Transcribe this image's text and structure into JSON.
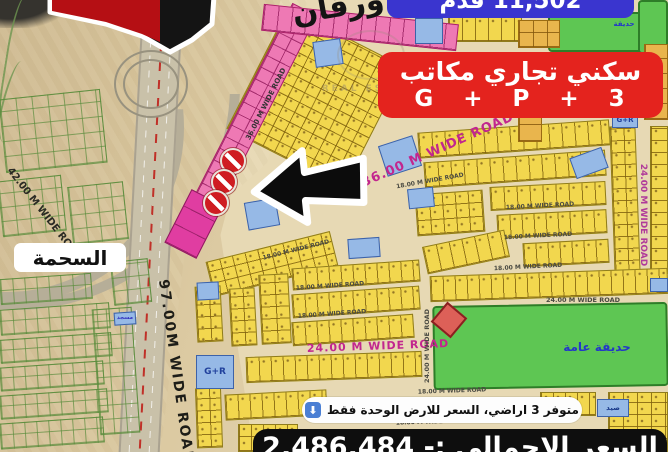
{
  "top_banner": {
    "text": "11,502 قدم",
    "bg": "#3a35cf"
  },
  "zoning_banner": {
    "line1": "سكني تجاري مكاتب",
    "line2": "G + P + 3",
    "bg": "#e4231e"
  },
  "district_label": {
    "text": "السحمة"
  },
  "availability_pill": {
    "text": "متوفر 3 اراضي، السعر للارض الوحدة فقط",
    "arrow_icon": "⬇"
  },
  "price_banner": {
    "text": "السعر الاجمالي :- 2,486,484"
  },
  "watermark": {
    "text": "REAL ESTATE"
  },
  "map": {
    "colors": {
      "plot_yellow": "#f2d74e",
      "plot_pink": "#ee79b4",
      "plot_magenta": "#e03da1",
      "plot_blue": "#96b9e6",
      "park_green": "#5ec653",
      "plot_orange": "#e9b54d",
      "road_text_magenta": "#c2268e",
      "banner_blue": "#3a35cf",
      "banner_red": "#e4231e",
      "marker_red": "#cf1d22"
    },
    "labels": [
      {
        "t": "ورقان",
        "x": 338,
        "y": 7,
        "r": -10,
        "s": 30,
        "c": "#141414",
        "rtl": true
      },
      {
        "t": "36.00 M WIDE ROAD",
        "x": 266,
        "y": 104,
        "r": -63,
        "s": 7,
        "c": "#333333"
      },
      {
        "t": "36.00 M WIDE ROAD",
        "x": 438,
        "y": 150,
        "r": -24,
        "s": 13,
        "c": "#c2268e",
        "ls": 1
      },
      {
        "t": "24.00 M WIDE ROAD",
        "x": 378,
        "y": 346,
        "r": -2,
        "s": 11,
        "c": "#c2268e",
        "ls": 1
      },
      {
        "t": "24.00 M WIDE ROAD",
        "x": 643,
        "y": 215,
        "r": 90,
        "s": 9,
        "c": "#b03a9a"
      },
      {
        "t": "24.00 M WIDE ROAD",
        "x": 583,
        "y": 300,
        "r": 0,
        "s": 6.5,
        "c": "#4a4a42"
      },
      {
        "t": "24.00 M WIDE ROAD",
        "x": 427,
        "y": 346,
        "r": -90,
        "s": 6.5,
        "c": "#4a4a42"
      },
      {
        "t": "18.00 M WIDE ROAD",
        "x": 430,
        "y": 181,
        "r": -10,
        "s": 6,
        "c": "#4a4a42"
      },
      {
        "t": "18.00 M WIDE ROAD",
        "x": 540,
        "y": 206,
        "r": -3,
        "s": 6,
        "c": "#4a4a42"
      },
      {
        "t": "18.00 M WIDE ROAD",
        "x": 538,
        "y": 236,
        "r": -3,
        "s": 6,
        "c": "#4a4a42"
      },
      {
        "t": "18.00 M WIDE ROAD",
        "x": 528,
        "y": 267,
        "r": -3,
        "s": 6,
        "c": "#4a4a42"
      },
      {
        "t": "18.00 M WIDE ROAD",
        "x": 296,
        "y": 250,
        "r": -14,
        "s": 6,
        "c": "#4a4a42"
      },
      {
        "t": "18.00 M WIDE ROAD",
        "x": 330,
        "y": 286,
        "r": -4,
        "s": 6,
        "c": "#4a4a42"
      },
      {
        "t": "18.00 M WIDE ROAD",
        "x": 332,
        "y": 314,
        "r": -4,
        "s": 6,
        "c": "#4a4a42"
      },
      {
        "t": "18.00 M WIDE ROAD",
        "x": 452,
        "y": 391,
        "r": -2,
        "s": 6,
        "c": "#4a4a42"
      },
      {
        "t": "18.00 M WIDE ROAD",
        "x": 430,
        "y": 422,
        "r": -2,
        "s": 6,
        "c": "#4a4a42"
      },
      {
        "t": "42.00 M WIDE ROAD",
        "x": 44,
        "y": 214,
        "r": 52,
        "s": 10,
        "c": "#2a2a24"
      },
      {
        "t": "97.00M WIDE ROAD",
        "x": 176,
        "y": 372,
        "r": 82,
        "s": 14,
        "c": "#1d1d18",
        "ls": 2
      },
      {
        "t": "G+R",
        "x": 215,
        "y": 372,
        "r": 0,
        "s": 9,
        "c": "#20409c"
      },
      {
        "t": "G+R",
        "x": 625,
        "y": 120,
        "r": 0,
        "s": 7,
        "c": "#20409c"
      },
      {
        "t": "حديقة عامة",
        "x": 597,
        "y": 347,
        "r": 0,
        "s": 12,
        "c": "#2438c8",
        "rtl": true
      },
      {
        "t": "حديقة",
        "x": 624,
        "y": 24,
        "r": 0,
        "s": 7,
        "c": "#2438c8",
        "rtl": true
      },
      {
        "t": "مسجد",
        "x": 125,
        "y": 318,
        "r": 0,
        "s": 5.5,
        "c": "#3636c0",
        "rtl": true
      },
      {
        "t": "صيد",
        "x": 613,
        "y": 408,
        "r": 0,
        "s": 7,
        "c": "#1a3a8a",
        "rtl": true
      }
    ],
    "plot_blocks": [
      {
        "k": "outline",
        "x": 2,
        "y": 94,
        "w": 102,
        "h": 74,
        "r": -6,
        "cw": 16,
        "ch": 15
      },
      {
        "k": "outline",
        "x": 0,
        "y": 178,
        "w": 64,
        "h": 56,
        "r": -6,
        "cw": 14,
        "ch": 14
      },
      {
        "k": "outline",
        "x": 70,
        "y": 184,
        "w": 56,
        "h": 58,
        "r": -6,
        "cw": 14,
        "ch": 14
      },
      {
        "k": "outline",
        "x": 112,
        "y": 260,
        "w": 38,
        "h": 44,
        "r": -6,
        "cw": 13,
        "ch": 13
      },
      {
        "k": "outline",
        "x": 0,
        "y": 276,
        "w": 92,
        "h": 26,
        "r": -4,
        "cw": 12,
        "ch": 13
      },
      {
        "k": "outline",
        "x": 0,
        "y": 306,
        "w": 110,
        "h": 26,
        "r": -4,
        "cw": 12,
        "ch": 13
      },
      {
        "k": "outline",
        "x": 0,
        "y": 336,
        "w": 112,
        "h": 24,
        "r": -4,
        "cw": 12,
        "ch": 12
      },
      {
        "k": "outline",
        "x": 0,
        "y": 364,
        "w": 104,
        "h": 24,
        "r": -4,
        "cw": 12,
        "ch": 12
      },
      {
        "k": "outline",
        "x": 0,
        "y": 392,
        "w": 108,
        "h": 24,
        "r": -4,
        "cw": 12,
        "ch": 12
      },
      {
        "k": "outline",
        "x": 0,
        "y": 420,
        "w": 104,
        "h": 26,
        "r": -4,
        "cw": 12,
        "ch": 13
      },
      {
        "k": "outline",
        "x": 96,
        "y": 308,
        "w": 40,
        "h": 126,
        "r": -4,
        "cw": 13,
        "ch": 14
      },
      {
        "k": "green",
        "x": 548,
        "y": 12,
        "w": 122,
        "h": 40,
        "r": 0
      },
      {
        "k": "green",
        "x": 638,
        "y": 0,
        "w": 30,
        "h": 54,
        "r": 0
      },
      {
        "k": "green",
        "x": 433,
        "y": 304,
        "w": 235,
        "h": 84,
        "r": -1
      },
      {
        "k": "yellow",
        "x": 250,
        "y": 30,
        "w": 132,
        "h": 136,
        "r": 27,
        "cw": 13,
        "ch": 11
      },
      {
        "k": "yellow",
        "x": 448,
        "y": 16,
        "w": 74,
        "h": 26,
        "r": 0,
        "cw": 13,
        "ch": 26
      },
      {
        "k": "yellow",
        "x": 418,
        "y": 126,
        "w": 192,
        "h": 26,
        "r": -4,
        "cw": 13,
        "ch": 26
      },
      {
        "k": "yellow",
        "x": 424,
        "y": 156,
        "w": 182,
        "h": 26,
        "r": -4,
        "cw": 13,
        "ch": 26
      },
      {
        "k": "yellow",
        "x": 416,
        "y": 192,
        "w": 68,
        "h": 42,
        "r": -4,
        "cw": 13,
        "ch": 14
      },
      {
        "k": "yellow",
        "x": 490,
        "y": 184,
        "w": 116,
        "h": 24,
        "r": -3,
        "cw": 13,
        "ch": 24
      },
      {
        "k": "yellow",
        "x": 612,
        "y": 126,
        "w": 26,
        "h": 148,
        "r": -2,
        "cw": 13,
        "ch": 12
      },
      {
        "k": "yellow",
        "x": 650,
        "y": 126,
        "w": 18,
        "h": 148,
        "r": 0,
        "cw": 18,
        "ch": 12
      },
      {
        "k": "yellow",
        "x": 497,
        "y": 212,
        "w": 110,
        "h": 24,
        "r": -3,
        "cw": 12,
        "ch": 24
      },
      {
        "k": "yellow",
        "x": 523,
        "y": 241,
        "w": 86,
        "h": 24,
        "r": -3,
        "cw": 12,
        "ch": 24
      },
      {
        "k": "yellow",
        "x": 424,
        "y": 238,
        "w": 84,
        "h": 28,
        "r": -12,
        "cw": 13,
        "ch": 28
      },
      {
        "k": "yellow",
        "x": 430,
        "y": 272,
        "w": 238,
        "h": 26,
        "r": -2,
        "cw": 12,
        "ch": 26
      },
      {
        "k": "yellow",
        "x": 208,
        "y": 246,
        "w": 128,
        "h": 36,
        "r": -14,
        "cw": 13,
        "ch": 12
      },
      {
        "k": "yellow",
        "x": 196,
        "y": 286,
        "w": 26,
        "h": 56,
        "r": -3,
        "cw": 13,
        "ch": 12
      },
      {
        "k": "yellow",
        "x": 230,
        "y": 288,
        "w": 26,
        "h": 58,
        "r": -3,
        "cw": 13,
        "ch": 12
      },
      {
        "k": "yellow",
        "x": 260,
        "y": 274,
        "w": 30,
        "h": 70,
        "r": -3,
        "cw": 15,
        "ch": 12
      },
      {
        "k": "yellow",
        "x": 292,
        "y": 264,
        "w": 128,
        "h": 22,
        "r": -4,
        "cw": 12,
        "ch": 22
      },
      {
        "k": "yellow",
        "x": 292,
        "y": 290,
        "w": 128,
        "h": 24,
        "r": -4,
        "cw": 12,
        "ch": 24
      },
      {
        "k": "yellow",
        "x": 292,
        "y": 318,
        "w": 122,
        "h": 24,
        "r": -4,
        "cw": 12,
        "ch": 24
      },
      {
        "k": "yellow",
        "x": 246,
        "y": 354,
        "w": 176,
        "h": 26,
        "r": -2,
        "cw": 12,
        "ch": 26
      },
      {
        "k": "yellow",
        "x": 225,
        "y": 392,
        "w": 102,
        "h": 26,
        "r": -3,
        "cw": 12,
        "ch": 26
      },
      {
        "k": "yellow",
        "x": 196,
        "y": 388,
        "w": 26,
        "h": 60,
        "r": -2,
        "cw": 13,
        "ch": 12
      },
      {
        "k": "yellow",
        "x": 238,
        "y": 424,
        "w": 60,
        "h": 28,
        "r": 0,
        "cw": 12,
        "ch": 14
      },
      {
        "k": "yellow",
        "x": 540,
        "y": 392,
        "w": 56,
        "h": 24,
        "r": 0,
        "cw": 12,
        "ch": 24
      },
      {
        "k": "yellow",
        "x": 608,
        "y": 392,
        "w": 60,
        "h": 60,
        "r": 0,
        "cw": 14,
        "ch": 12
      },
      {
        "k": "orange",
        "x": 518,
        "y": 20,
        "w": 42,
        "h": 28,
        "r": 0,
        "cw": 14,
        "ch": 14
      },
      {
        "k": "orange",
        "x": 644,
        "y": 44,
        "w": 24,
        "h": 76,
        "r": 0,
        "cw": 24,
        "ch": 15
      },
      {
        "k": "orange",
        "x": 518,
        "y": 110,
        "w": 24,
        "h": 32,
        "r": 0,
        "cw": 24,
        "ch": 16
      },
      {
        "k": "orange",
        "x": 606,
        "y": 94,
        "w": 30,
        "h": 26,
        "r": 15,
        "cw": 15,
        "ch": 13
      },
      {
        "k": "pink",
        "x": 236,
        "y": -4,
        "w": 28,
        "h": 242,
        "r": 27,
        "cw": 14,
        "ch": 13
      },
      {
        "k": "pink",
        "x": 262,
        "y": 14,
        "w": 196,
        "h": 27,
        "r": 6,
        "cw": 14,
        "ch": 27
      },
      {
        "k": "magenta",
        "x": 176,
        "y": 194,
        "w": 36,
        "h": 60,
        "r": 27,
        "cw": 18,
        "ch": 20
      },
      {
        "k": "blue",
        "x": 415,
        "y": 18,
        "w": 28,
        "h": 26,
        "r": 0
      },
      {
        "k": "blue",
        "x": 314,
        "y": 40,
        "w": 28,
        "h": 26,
        "r": -8
      },
      {
        "k": "blue",
        "x": 382,
        "y": 140,
        "w": 36,
        "h": 32,
        "r": -18
      },
      {
        "k": "blue",
        "x": 408,
        "y": 188,
        "w": 26,
        "h": 20,
        "r": -6
      },
      {
        "k": "blue",
        "x": 572,
        "y": 152,
        "w": 34,
        "h": 22,
        "r": -20
      },
      {
        "k": "blue",
        "x": 246,
        "y": 200,
        "w": 32,
        "h": 28,
        "r": -10
      },
      {
        "k": "blue",
        "x": 348,
        "y": 238,
        "w": 32,
        "h": 20,
        "r": -4
      },
      {
        "k": "blue",
        "x": 196,
        "y": 355,
        "w": 38,
        "h": 34,
        "r": 0
      },
      {
        "k": "blue",
        "x": 650,
        "y": 278,
        "w": 18,
        "h": 14,
        "r": 0
      },
      {
        "k": "blue",
        "x": 597,
        "y": 399,
        "w": 32,
        "h": 18,
        "r": 0
      },
      {
        "k": "blue",
        "x": 612,
        "y": 112,
        "w": 26,
        "h": 16,
        "r": 0
      },
      {
        "k": "blue",
        "x": 114,
        "y": 312,
        "w": 22,
        "h": 13,
        "r": -4
      },
      {
        "k": "blue",
        "x": 197,
        "y": 282,
        "w": 22,
        "h": 18,
        "r": -3
      },
      {
        "k": "reddiamond",
        "x": 436,
        "y": 307,
        "w": 26,
        "h": 26,
        "r": 40
      }
    ],
    "no_markers": [
      {
        "x": 233,
        "y": 161
      },
      {
        "x": 224,
        "y": 182
      },
      {
        "x": 216,
        "y": 203
      }
    ]
  }
}
